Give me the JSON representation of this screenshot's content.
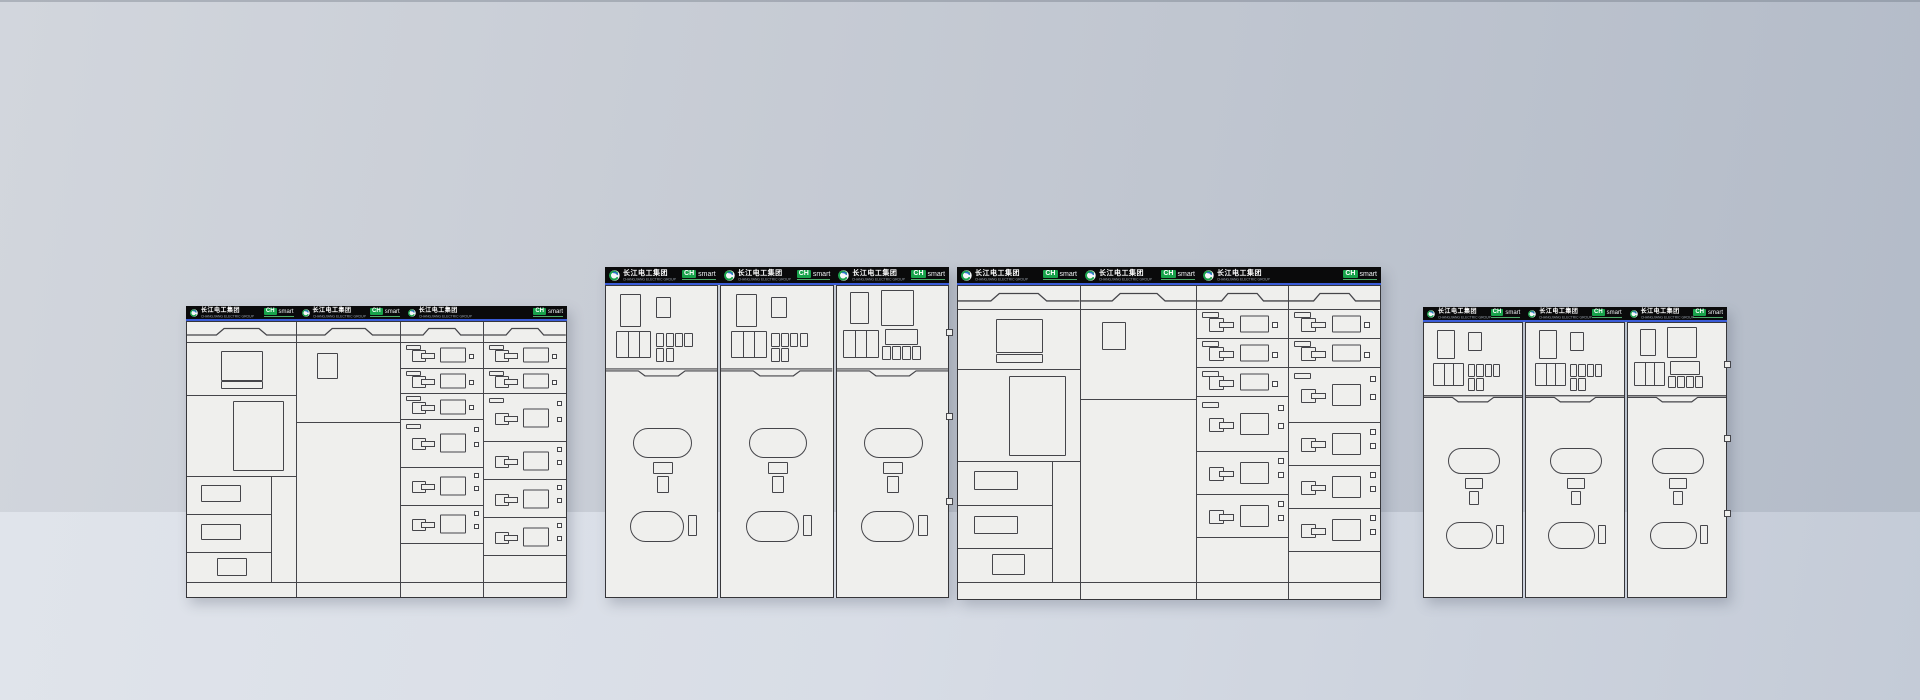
{
  "brand": {
    "logo_text": "长江电工集团",
    "logo_subtext": "CHANGJIANG ELECTRIC GROUP",
    "badge_primary": "CH",
    "badge_secondary": "smart",
    "logo_green": "#18a34b",
    "logo_blue": "#2e6fd0",
    "header_black": "#0a0a0b",
    "header_underline_blue": "#3a5cd8"
  },
  "palette": {
    "wall_gradient": [
      "#d2d6dd",
      "#b3bbc8"
    ],
    "floor_gradient": [
      "#e0e4eb",
      "#c4cbd7"
    ],
    "floor_top_y": 512,
    "panel_fill": "#efefed",
    "line_color": "#45454a",
    "border_color": "#36363a"
  },
  "lv_template": {
    "column_widths": [
      0.29,
      0.275,
      0.2175,
      0.2175
    ],
    "col3_drawers": [
      {
        "slot": true,
        "size": "s",
        "dots": 1
      },
      {
        "slot": true,
        "size": "s",
        "dots": 1
      },
      {
        "slot": true,
        "size": "s",
        "dots": 1
      },
      {
        "slot": true,
        "size": "l",
        "dots": 2
      },
      {
        "slot": false,
        "size": "m",
        "dots": 2
      },
      {
        "slot": false,
        "size": "m",
        "dots": 2
      }
    ],
    "col3_tail": 1.55,
    "col4_drawers": [
      {
        "slot": true,
        "size": "s",
        "dots": 1
      },
      {
        "slot": true,
        "size": "s",
        "dots": 1
      },
      {
        "slot": true,
        "size": "l",
        "dots": 2
      },
      {
        "slot": false,
        "size": "m",
        "dots": 2
      },
      {
        "slot": false,
        "size": "m",
        "dots": 2
      },
      {
        "slot": false,
        "size": "m",
        "dots": 2
      }
    ],
    "col4_tail": 1.05
  },
  "mv_template": {
    "columns": [
      "standard",
      "standard",
      "alternate"
    ]
  },
  "groups": [
    {
      "id": "lv-lineup-small",
      "kind": "lv",
      "x": 186,
      "y": 306,
      "w": 381,
      "h": 292,
      "header_h": 13
    },
    {
      "id": "mv-lineup-large",
      "kind": "mv",
      "x": 605,
      "y": 267,
      "w": 344,
      "h": 331,
      "header_h": 16
    },
    {
      "id": "lv-lineup-large",
      "kind": "lv",
      "x": 957,
      "y": 267,
      "w": 424,
      "h": 333,
      "header_h": 16
    },
    {
      "id": "mv-lineup-small",
      "kind": "mv",
      "x": 1423,
      "y": 307,
      "w": 304,
      "h": 291,
      "header_h": 13
    }
  ]
}
